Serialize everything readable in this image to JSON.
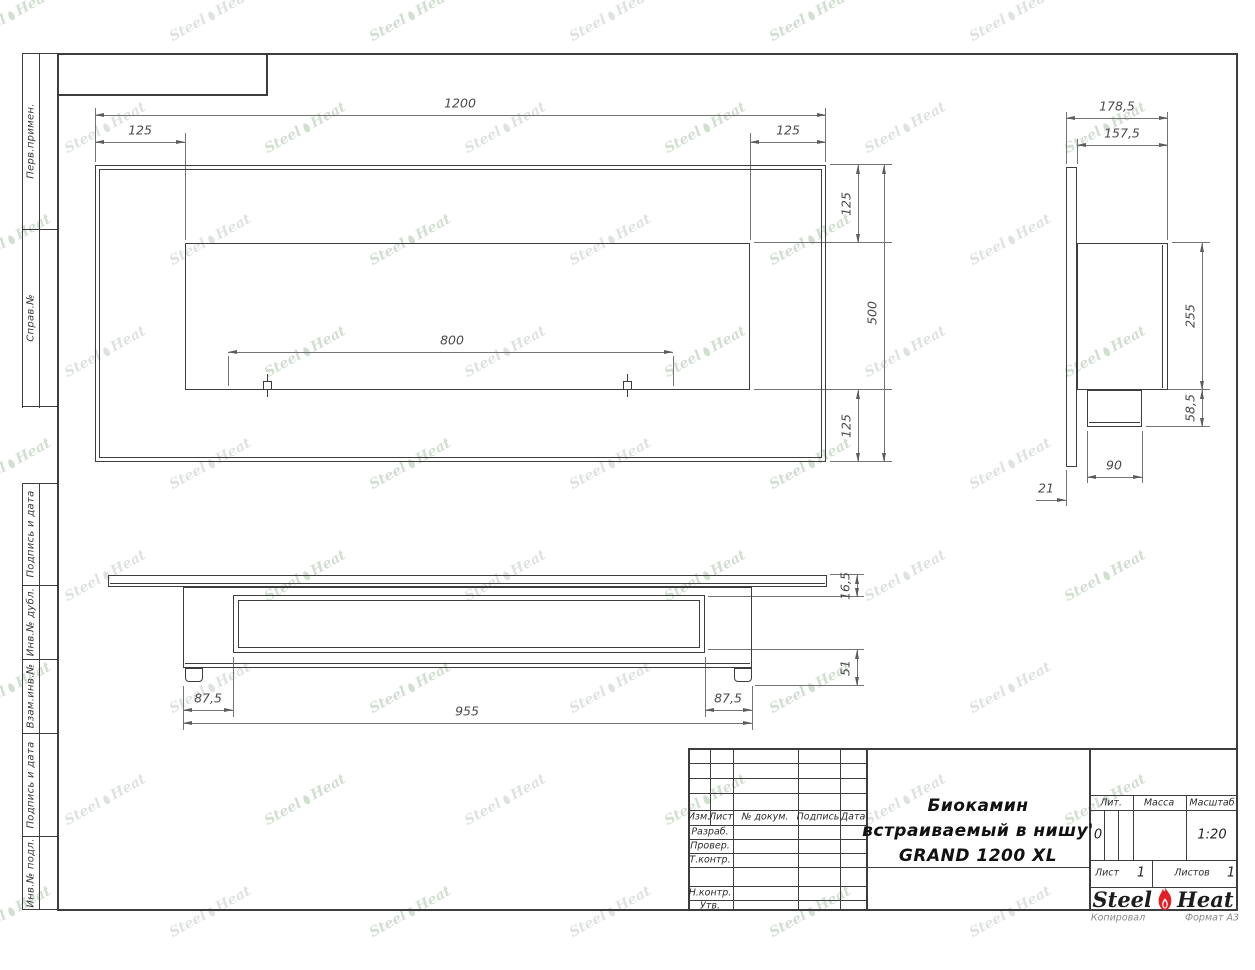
{
  "sheet": {
    "watermark": {
      "steel": "Steel",
      "heat": "Heat"
    },
    "footer": {
      "copied": "Копировал",
      "format": "Формат А3"
    },
    "left_columns": {
      "top": [
        "Перв.примен.",
        "Справ.№"
      ],
      "bottom": [
        "Подпись и дата",
        "Инв.№ дубл.",
        "Взам.инв.№",
        "Подпись и дата",
        "Инв.№ подл."
      ]
    },
    "title_block": {
      "change_header": [
        "Изм.",
        "Лист",
        "№ докум.",
        "Подпись",
        "Дата"
      ],
      "role_rows": [
        "Разраб.",
        "Провер.",
        "Т.контр.",
        "Н.контр.",
        "Утв."
      ],
      "title_lines": [
        "Биокамин",
        "встраиваемый в нишу'",
        "GRAND 1200 XL"
      ],
      "lit": {
        "label": "Лит.",
        "value": "0"
      },
      "mass": {
        "label": "Масса",
        "value": ""
      },
      "scale": {
        "label": "Масштаб",
        "value": "1:20"
      },
      "sheet_no": {
        "label": "Лист",
        "value": "1"
      },
      "sheets_total": {
        "label": "Листов",
        "value": "1"
      },
      "logo": {
        "steel": "Steel",
        "heat": "Heat"
      }
    },
    "views": {
      "front": {
        "dims": {
          "width": "1200",
          "left": "125",
          "right": "125",
          "top": "125",
          "height": "500",
          "bottom": "125",
          "burner": "800"
        }
      },
      "side": {
        "dims": {
          "depth": "178,5",
          "inner_depth": "157,5",
          "niche": "255",
          "lower": "58,5",
          "lower_depth": "90",
          "panel": "21"
        }
      },
      "bottom": {
        "dims": {
          "flange": "16,5",
          "inner": "51",
          "left": "87,5",
          "right": "87,5",
          "width": "955"
        }
      }
    },
    "colors": {
      "flame": "#e31e24",
      "line": "#3d3d3d",
      "dim": "#737373",
      "watermark_gray": "#c6cdc6",
      "watermark_green": "#aec4ae"
    }
  }
}
